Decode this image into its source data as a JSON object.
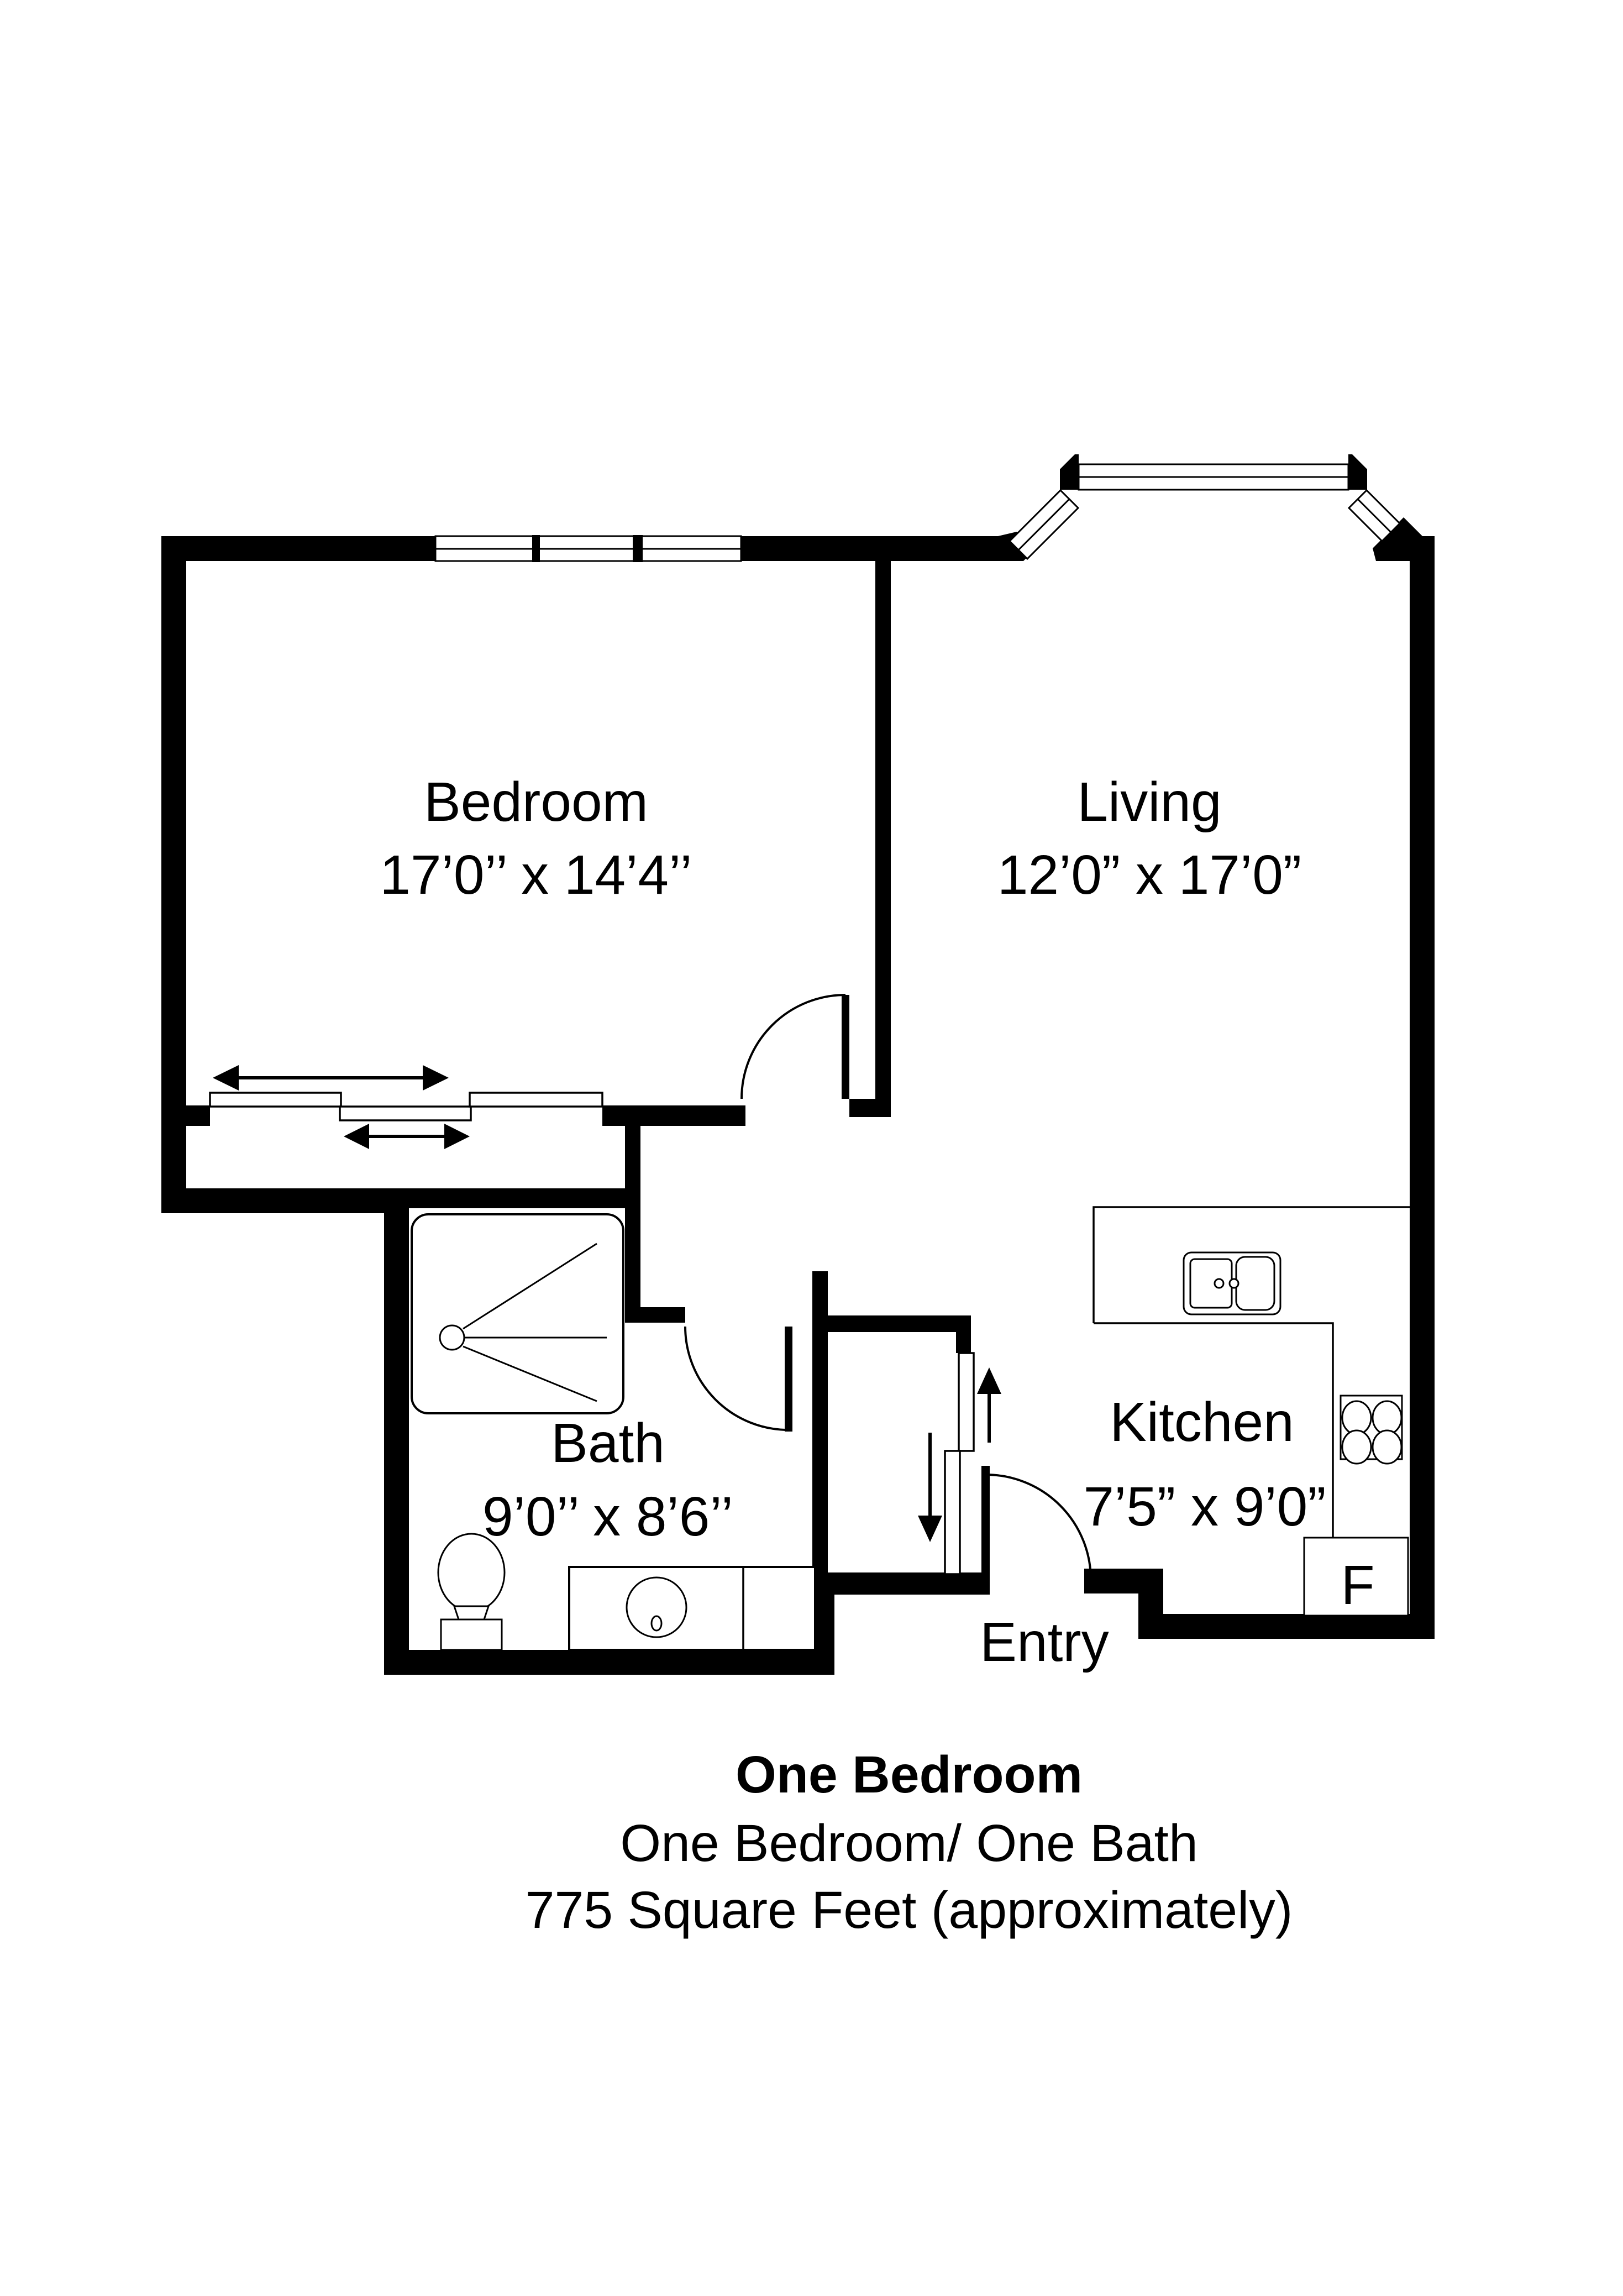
{
  "background": "#ffffff",
  "wall_color": "#000000",
  "rooms": {
    "bedroom": {
      "name": "Bedroom",
      "dims": "17’0’’ x 14’4’’"
    },
    "living": {
      "name": "Living",
      "dims": "12’0” x 17’0”"
    },
    "bath": {
      "name": "Bath",
      "dims": "9’0’’ x 8’6’’"
    },
    "kitchen": {
      "name": "Kitchen",
      "dims": "7’5” x 9’0”"
    }
  },
  "labels": {
    "entry": "Entry",
    "fridge": "F"
  },
  "caption": {
    "title": "One Bedroom",
    "subtitle": "One Bedroom/ One Bath",
    "area": "775 Square Feet (approximately)"
  }
}
